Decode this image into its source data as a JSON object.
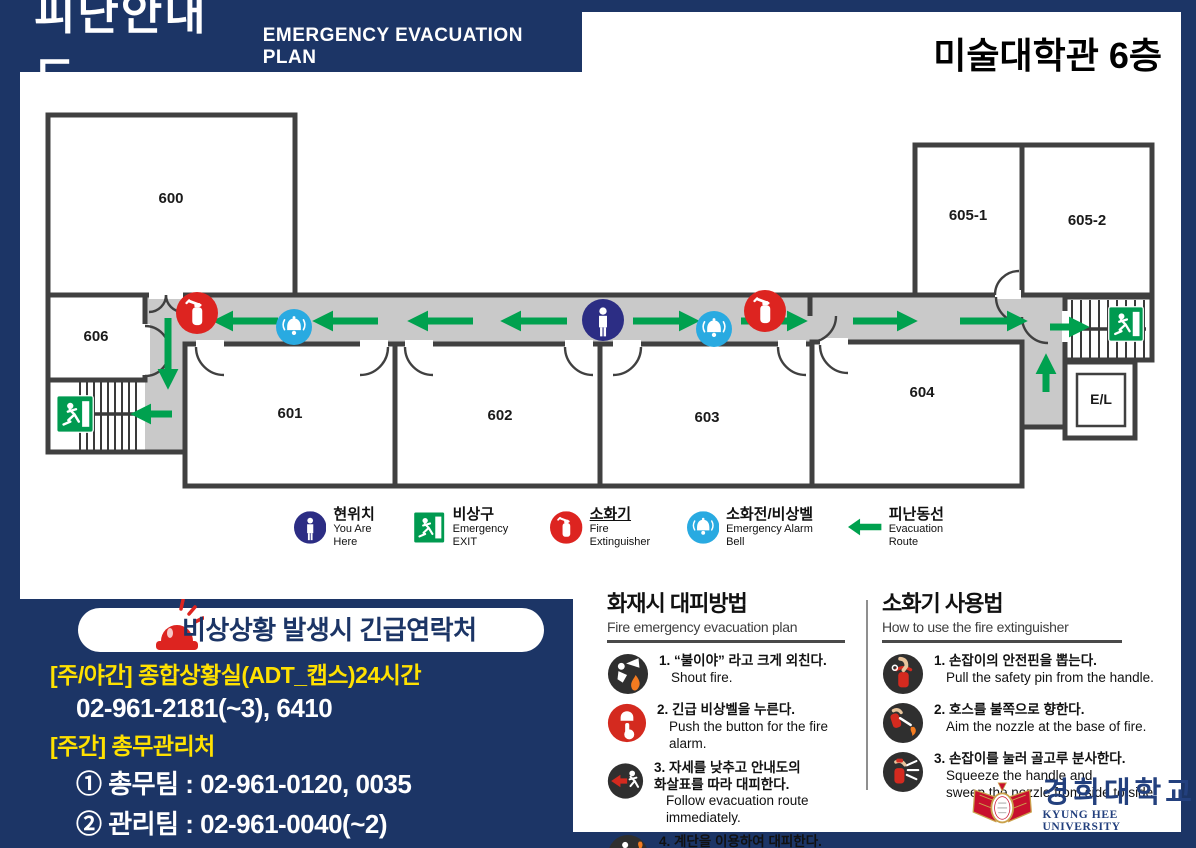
{
  "header": {
    "title_ko": "피난안내도",
    "title_en": "EMERGENCY EVACUATION PLAN",
    "building": "미술대학관 6층"
  },
  "floorplan": {
    "rooms": [
      {
        "label": "600"
      },
      {
        "label": "606"
      },
      {
        "label": "601"
      },
      {
        "label": "602"
      },
      {
        "label": "603"
      },
      {
        "label": "604"
      },
      {
        "label": "605-1"
      },
      {
        "label": "605-2"
      },
      {
        "label": "E/L"
      }
    ]
  },
  "legend": {
    "items": [
      {
        "icon": "you-are-here-icon",
        "ko": "현위치",
        "en": "You Are Here"
      },
      {
        "icon": "emergency-exit-icon",
        "ko": "비상구",
        "en": "Emergency EXIT"
      },
      {
        "icon": "fire-extinguisher-icon",
        "ko": "소화기",
        "en": "Fire Extinguisher"
      },
      {
        "icon": "alarm-bell-icon",
        "ko": "소화전/비상벨",
        "en": "Emergency Alarm Bell"
      },
      {
        "icon": "evacuation-route-arrow-icon",
        "ko": "피난동선",
        "en": "Evacuation Route"
      }
    ]
  },
  "contacts": {
    "banner": "비상상황 발생시 긴급연락처",
    "lines": [
      {
        "style": "yellow",
        "text": "[주/야간] 종합상황실(ADT_캡스)24시간"
      },
      {
        "style": "white",
        "text": "02-961-2181(~3), 6410"
      },
      {
        "style": "yellow",
        "text": "[주간] 총무관리처"
      },
      {
        "style": "white",
        "text": "① 총무팀 : 02-961-0120, 0035"
      },
      {
        "style": "white",
        "text": "② 관리팀 : 02-961-0040(~2)"
      },
      {
        "style": "white",
        "text": "③ 안전팀 : 02-961-0119"
      }
    ]
  },
  "fire_plan": {
    "title_ko": "화재시 대피방법",
    "title_en": "Fire emergency evacuation plan",
    "steps": [
      {
        "ko": "1. “불이야” 라고 크게 외친다.",
        "en": "Shout fire."
      },
      {
        "ko": "2. 긴급 비상벨을 누른다.",
        "en": "Push the button for the fire alarm."
      },
      {
        "ko": "3. 자세를 낮추고 안내도의\n화살표를 따라 대피한다.",
        "en": "Follow evacuation route immediately."
      },
      {
        "ko": "4. 계단을 이용하여 대피한다.",
        "en": "Evacucuate through the stairs."
      }
    ]
  },
  "ext_guide": {
    "title_ko": "소화기 사용법",
    "title_en": "How to use the fire extinguisher",
    "steps": [
      {
        "ko": "1. 손잡이의 안전핀을 뽑는다.",
        "en": "Pull the safety pin from the handle."
      },
      {
        "ko": "2. 호스를 불쪽으로 향한다.",
        "en": "Aim the nozzle at the base of fire."
      },
      {
        "ko": "3. 손잡이를 눌러 골고루 분사한다.",
        "en": "Squeeze the handle and\nsweep the nozzle from side to side."
      }
    ]
  },
  "university": {
    "name_ko": "경희대학교",
    "name_en": "KYUNG HEE UNIVERSITY"
  },
  "colors": {
    "navy": "#1c3566",
    "route_green": "#00a14f",
    "exit_green": "#009a50",
    "alert_red": "#dd2420",
    "bell_blue": "#29aae1",
    "here_indigo": "#2c2d84",
    "highlight_yellow": "#ffe100",
    "corridor_gray": "#c9c9c9",
    "wall_gray": "#404040"
  }
}
